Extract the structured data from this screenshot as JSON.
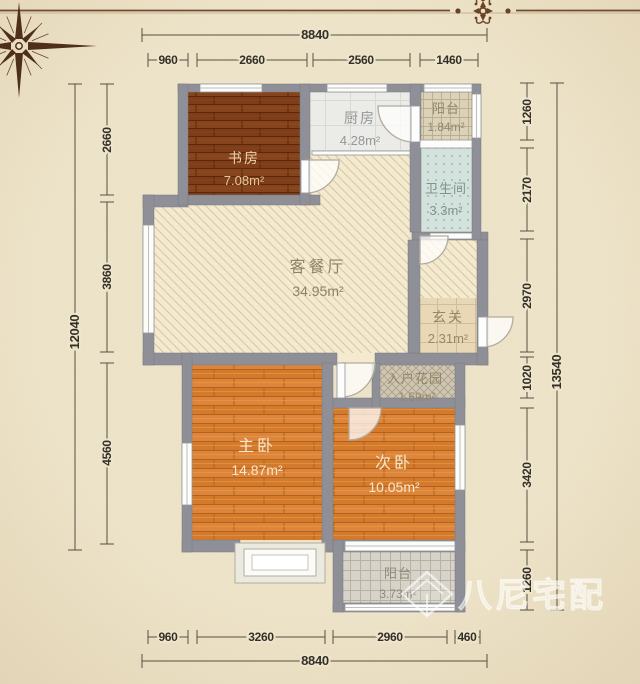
{
  "rooms": {
    "study": {
      "name": "书房",
      "area": "7.08m²"
    },
    "kitchen": {
      "name": "厨房",
      "area": "4.28m²"
    },
    "balcony_top": {
      "name": "阳台",
      "area": "1.84m²"
    },
    "bathroom": {
      "name": "卫生间",
      "area": "3.3m²"
    },
    "living_dining": {
      "name": "客餐厅",
      "area": "34.95m²"
    },
    "entry_hall": {
      "name": "玄关",
      "area": "2.31m²"
    },
    "entry_garden": {
      "name": "入户花园",
      "area": "1.59m²"
    },
    "master_bedroom": {
      "name": "主卧",
      "area": "14.87m²"
    },
    "second_bedroom": {
      "name": "次卧",
      "area": "10.05m²"
    },
    "balcony_bottom": {
      "name": "阳台",
      "area": "3.73m²"
    }
  },
  "dimensions": {
    "top": {
      "total": "8840",
      "segments": [
        "960",
        "2660",
        "2560",
        "1460"
      ]
    },
    "bottom": {
      "total": "8840",
      "segments": [
        "960",
        "3260",
        "2960",
        "460"
      ]
    },
    "left": {
      "total": "12040",
      "segments": [
        "2660",
        "3860",
        "4560"
      ]
    },
    "right": {
      "total": "13540",
      "segments": [
        "1260",
        "2170",
        "2970",
        "1020",
        "3420",
        "1260"
      ]
    }
  },
  "watermark": {
    "text": "八尼宅配"
  },
  "colors": {
    "paper": "#efe5ca",
    "wall": "#8f8f97",
    "dark_wood": "#7e3d18",
    "orange_wood": "#dd853a",
    "living_hatch_bg": "#f4ead0",
    "bath_tile": "#d3e2dc",
    "accent_brown": "#6f4b30"
  }
}
